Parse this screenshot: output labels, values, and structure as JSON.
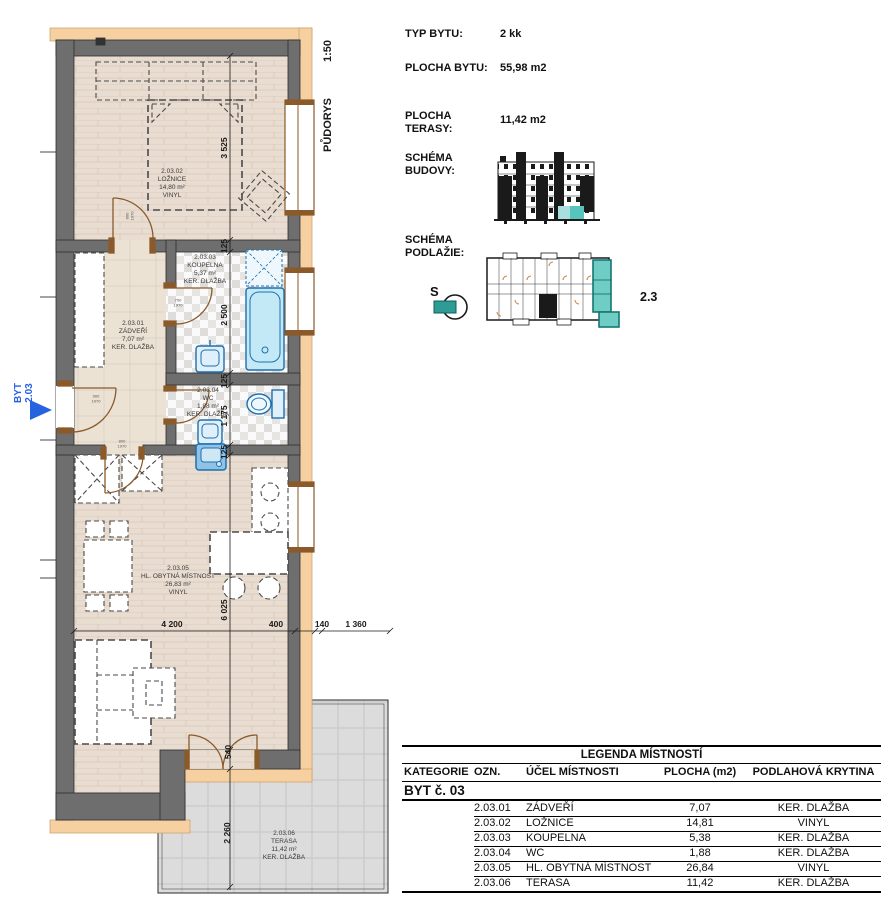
{
  "colors": {
    "insulation_peach": "#f6d0a0",
    "wall_gray": "#6e6e6e",
    "fixture_blue": "#1d6fb0",
    "entrance_blue": "#2563e0",
    "highlight_teal": "#57c5bd",
    "door_brown": "#8a5a2a"
  },
  "info_panel": {
    "rows": [
      {
        "label": "TYP BYTU:",
        "value": "2 kk"
      },
      {
        "label": "PLOCHA BYTU:",
        "value": "55,98 m2"
      },
      {
        "label": "PLOCHA TERASY:",
        "value": "11,42 m2"
      }
    ],
    "schema_budovy_label": "SCHÉMA BUDOVY:",
    "schema_podlazie_label": "SCHÉMA PODLAŽIE:",
    "north_label": "S",
    "unit_marker": "2.3"
  },
  "floorplan": {
    "scale": "1:50",
    "drawing_title": "PŮDORYS",
    "entrance": {
      "line1": "BYT",
      "line2": "2.03"
    },
    "rooms": {
      "zadveri": {
        "code": "2.03.01",
        "name": "ZÁDVEŘÍ",
        "area": "7,07 m²",
        "floor": "KER. DLAŽBA"
      },
      "loznice": {
        "code": "2.03.02",
        "name": "LOŽNICE",
        "area": "14,80 m²",
        "floor": "VINYL"
      },
      "koupelna": {
        "code": "2.03.03",
        "name": "KOUPELNA",
        "area": "5,37 m²",
        "floor": "KER. DLAŽBA"
      },
      "wc": {
        "code": "2.03.04",
        "name": "WC",
        "area": "1,88 m²",
        "floor": "KER. DLAŽBA"
      },
      "hlavni": {
        "code": "2.03.05",
        "name": "HL. OBYTNÁ MÍSTNOST",
        "area": "26,83 m²",
        "floor": "VINYL"
      },
      "terasa": {
        "code": "2.03.06",
        "name": "TERASA",
        "area": "11,42 m²",
        "floor": "KER. DLAŽBA"
      }
    },
    "dimensions": {
      "bedroom_height": "3 525",
      "wall_a": "125",
      "bathroom_height": "2 500",
      "wall_b": "125",
      "wc_height": "1 175",
      "wall_c": "125",
      "living_height": "6 025",
      "living_width": "4 200",
      "offset_a": "400",
      "offset_b": "140",
      "terrace_width": "1 360",
      "terrace_door": "540",
      "terrace_depth": "2 260"
    },
    "door_sizes": {
      "bedroom": [
        "800",
        "1970"
      ],
      "entrance": [
        "900",
        "1970"
      ],
      "bathroom": [
        "700",
        "1970"
      ],
      "living": [
        "800",
        "1970"
      ]
    }
  },
  "legend_table": {
    "title": "LEGENDA MÍSTNOSTÍ",
    "columns": [
      "KATEGORIE",
      "OZN.",
      "ÚČEL MÍSTNOSTI",
      "PLOCHA (m2)",
      "PODLAHOVÁ KRYTINA"
    ],
    "group": "BYT č. 03",
    "rows": [
      {
        "ozn": "2.03.01",
        "ucel": "ZÁDVEŘÍ",
        "plocha": "7,07",
        "krytina": "KER. DLAŽBA"
      },
      {
        "ozn": "2.03.02",
        "ucel": "LOŽNICE",
        "plocha": "14,81",
        "krytina": "VINYL"
      },
      {
        "ozn": "2.03.03",
        "ucel": "KOUPELNA",
        "plocha": "5,38",
        "krytina": "KER. DLAŽBA"
      },
      {
        "ozn": "2.03.04",
        "ucel": "WC",
        "plocha": "1,88",
        "krytina": "KER. DLAŽBA"
      },
      {
        "ozn": "2.03.05",
        "ucel": "HL. OBYTNÁ MÍSTNOST",
        "plocha": "26,84",
        "krytina": "VINYL"
      },
      {
        "ozn": "2.03.06",
        "ucel": "TERASA",
        "plocha": "11,42",
        "krytina": "KER. DLAŽBA"
      }
    ]
  }
}
